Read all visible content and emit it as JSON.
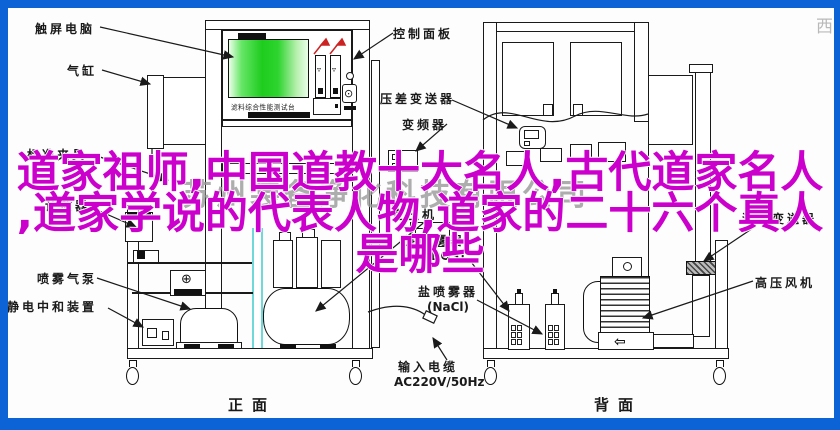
{
  "colors": {
    "frame_blue": "#0b63d6",
    "overlay_magenta": "#cc00cc",
    "screen_green": "#1ecc1e",
    "accent_red": "#cc2222",
    "tube_cyan": "#6fd8d8"
  },
  "overlay": {
    "line1": "道家祖师,中国道教十大名人,古代道家名人",
    "line2": ",道家学说的代表人物,道家的二十六个真人",
    "line3": "是哪些"
  },
  "watermark": {
    "company": "苏州装备净化科技有限公司",
    "corner": "西"
  },
  "console": {
    "caption": "滤料综合性能测试台"
  },
  "labels": {
    "touchscreen": "触屏电脑",
    "cylinder": "气缸",
    "fixture": "标准夹具",
    "counter": "计数器",
    "spray_pump": "喷雾气泵",
    "static_neutralizer": "静电中和装置",
    "control_panel": "控制面板",
    "dp_transmitter": "压差变送器",
    "inverter": "变频器",
    "flow_transmitter": "流量变送器",
    "hp_blower": "高压风机",
    "compressor": "空压机",
    "oil_sprayer": "油喷雾器",
    "oil_sprayer_sub": "(DOS)",
    "salt_sprayer": "盐喷雾器",
    "salt_sprayer_sub": "(NaCl)",
    "input_cable": "输入电缆",
    "input_cable_sub": "AC220V/50Hz",
    "view_front": "正面",
    "view_back": "背面"
  },
  "glyphs": {
    "blower_arrow": "⇦",
    "plus_device": "⊕",
    "keypad": "⊙",
    "rotameter_float": "▿"
  }
}
